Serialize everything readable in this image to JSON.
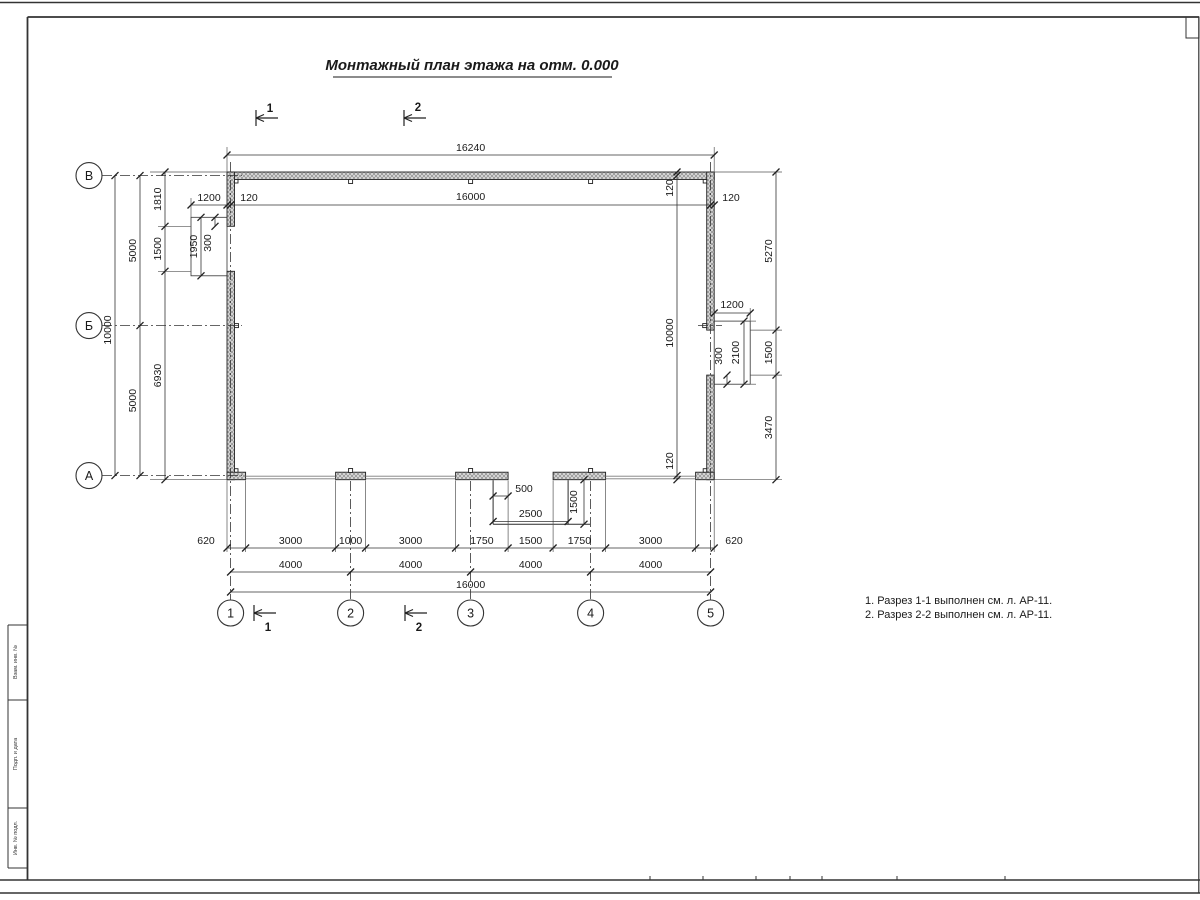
{
  "title": "Монтажный план этажа на отм. 0.000",
  "notes": [
    "1. Разрез 1-1 выполнен см. л. АР-11.",
    "2. Разрез 2-2 выполнен см. л. АР-11."
  ],
  "axes": {
    "cols": [
      "1",
      "2",
      "3",
      "4",
      "5"
    ],
    "rows": [
      "В",
      "Б",
      "А"
    ]
  },
  "sections": {
    "s1": "1",
    "s2": "2"
  },
  "dims": {
    "overall_w": "16240",
    "top": [
      "1200",
      "120",
      "16000",
      "120"
    ],
    "left_outer": [
      "1810",
      "1500",
      "6930"
    ],
    "left_mid": [
      "5000",
      "5000"
    ],
    "left_total": "10000",
    "left_niche": {
      "h": "1950",
      "off": "300"
    },
    "right_inner": [
      "120",
      "10000",
      "120"
    ],
    "right_outer": [
      "5270",
      "1500",
      "3470"
    ],
    "right_niche": {
      "w": "1200",
      "off": "300",
      "h": "2100"
    },
    "bottom1": [
      "620",
      "3000",
      "1000",
      "3000",
      "1750",
      "1500",
      "1750",
      "3000",
      "620"
    ],
    "bottom2": [
      "4000",
      "4000",
      "4000",
      "4000"
    ],
    "bottom_total": "16000",
    "porch": {
      "off": "500",
      "w": "2500",
      "d": "1500"
    }
  },
  "stamps": [
    "Взам. инв. №",
    "Подп. и дата",
    "Инв. № подл."
  ]
}
